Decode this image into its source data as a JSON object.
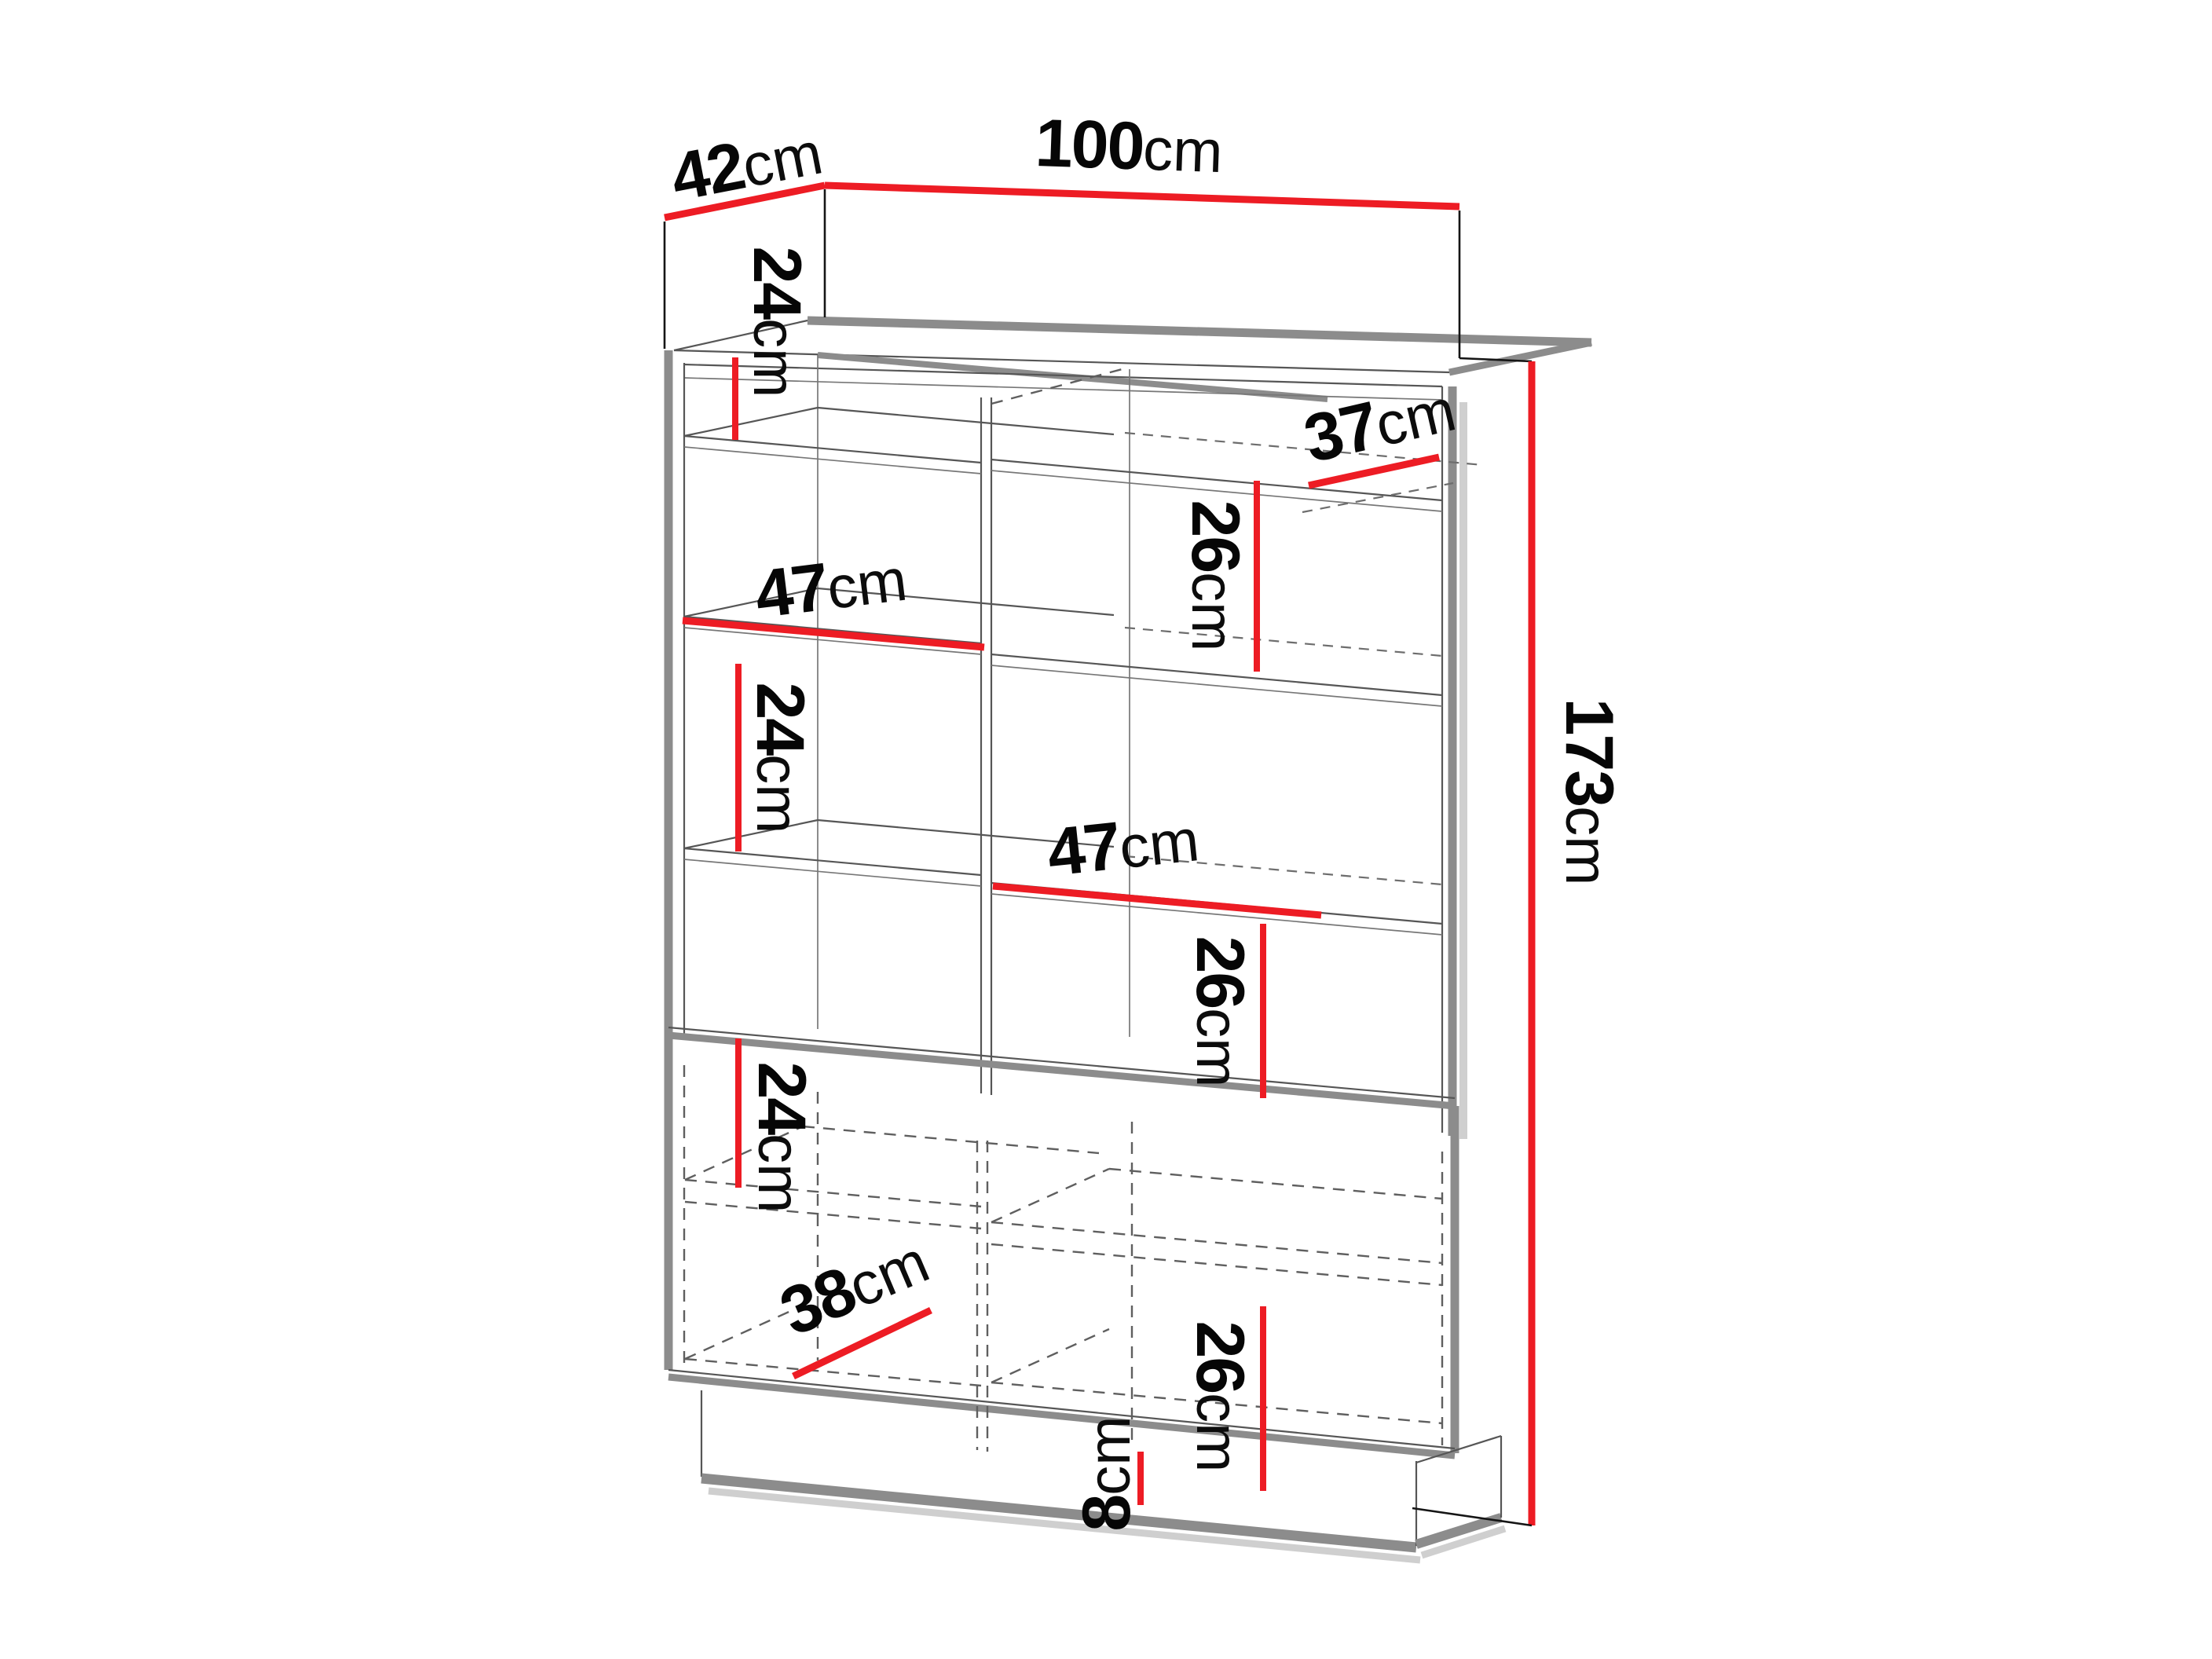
{
  "diagram": {
    "kind": "furniture-dimension-drawing",
    "unit": "cm"
  },
  "dimensions": {
    "depth_top": {
      "value": "42",
      "unit": "cm"
    },
    "width_top": {
      "value": "100",
      "unit": "cm"
    },
    "height_overall": {
      "value": "173",
      "unit": "cm"
    },
    "top_right_shelf_depth": {
      "value": "37",
      "unit": "cm"
    },
    "left_cell_top_height": {
      "value": "24",
      "unit": "cm"
    },
    "left_shelf_width": {
      "value": "47",
      "unit": "cm"
    },
    "left_cell_mid_height": {
      "value": "24",
      "unit": "cm"
    },
    "right_cell_top_height": {
      "value": "26",
      "unit": "cm"
    },
    "right_shelf_width": {
      "value": "47",
      "unit": "cm"
    },
    "right_cell_mid_height": {
      "value": "26",
      "unit": "cm"
    },
    "door_cell_left_height": {
      "value": "24",
      "unit": "cm"
    },
    "bottom_shelf_width": {
      "value": "38",
      "unit": "cm"
    },
    "bottom_right_cell_height": {
      "value": "26",
      "unit": "cm"
    },
    "plinth_height": {
      "value": "8",
      "unit": "cm"
    }
  },
  "colors": {
    "dimension_accent": "#ed1c24",
    "cabinet_outline": "#8c8c8c",
    "line_dark": "#565656"
  }
}
